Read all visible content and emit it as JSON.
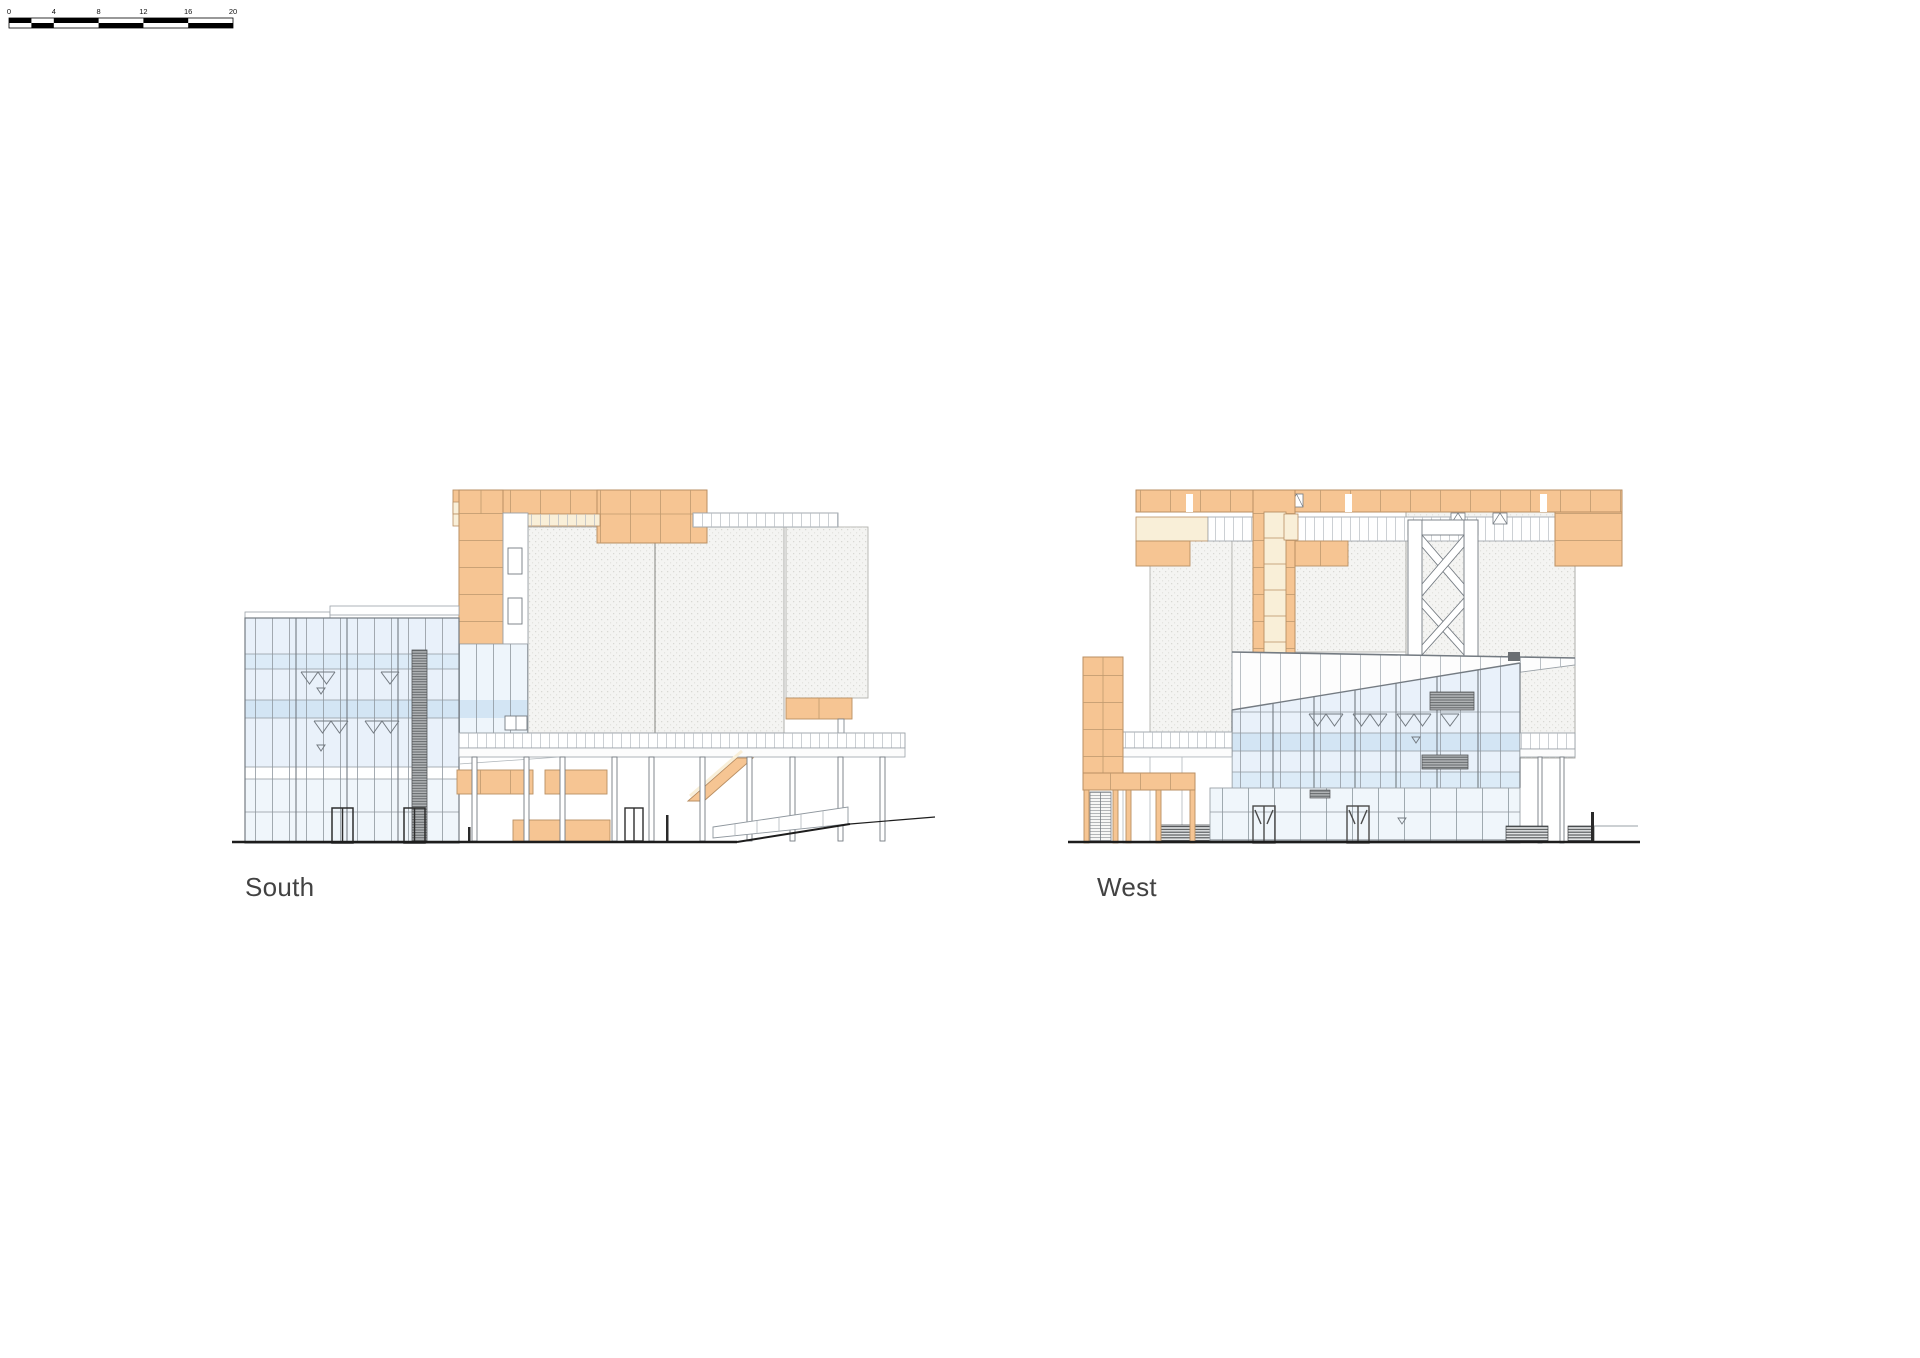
{
  "elevations": {
    "south": {
      "label": "South"
    },
    "west": {
      "label": "West"
    }
  },
  "scale_bar": {
    "tick_labels": [
      "0",
      "4",
      "8",
      "12",
      "16",
      "20"
    ]
  },
  "palette": {
    "orange_panel": "#f6c593",
    "cream_panel": "#f9efd8",
    "glass": "#e9f1fa",
    "glass_tint": "#d3e5f4",
    "glass_tint_light": "#dcebf7",
    "storefront": "#f0f6fb",
    "concrete_stipple": "#f4f4f2",
    "louver_dark": "#6b6f73",
    "ground_line": "#1d1d1d",
    "label_text": "#424242"
  }
}
